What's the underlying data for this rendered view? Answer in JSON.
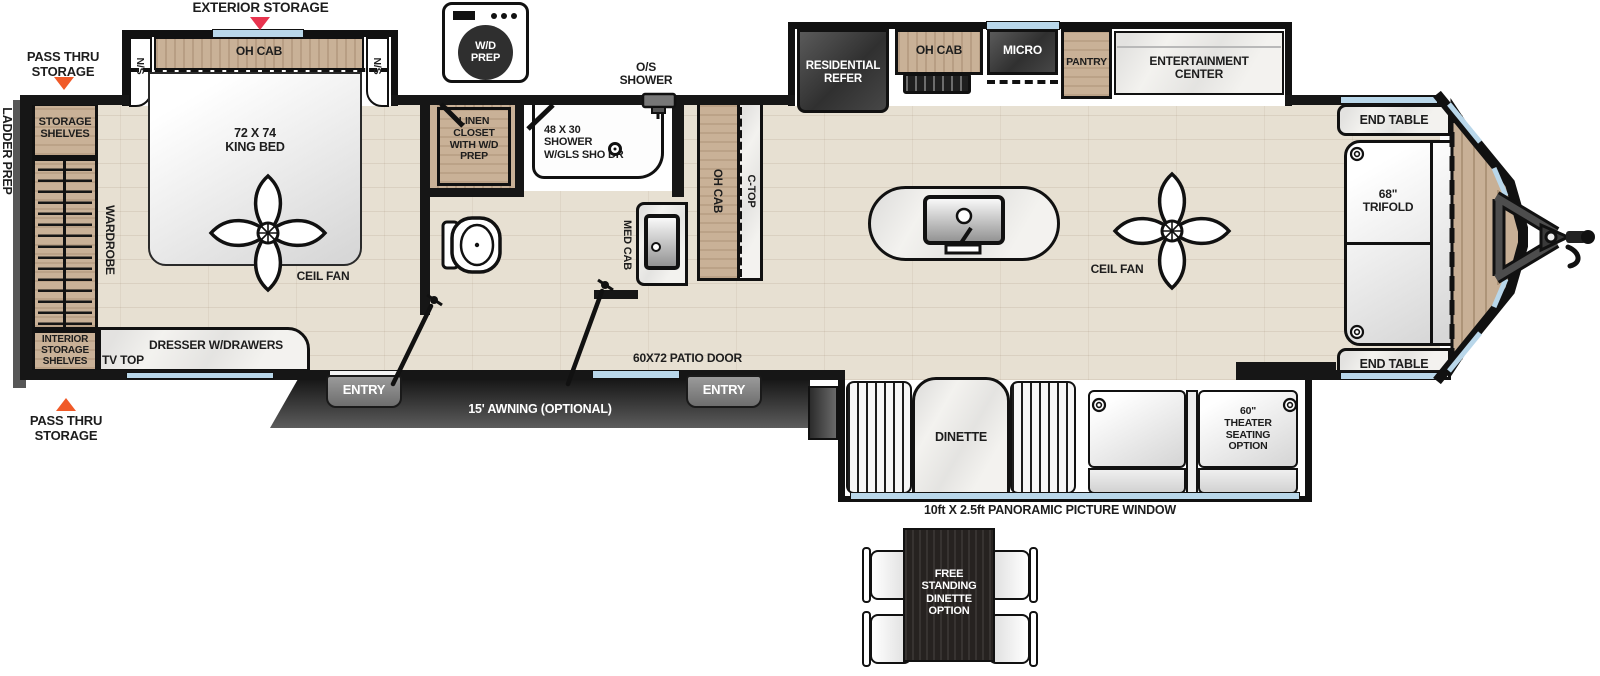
{
  "title": "Travel trailer floorplan",
  "labels": {
    "exterior_storage": "EXTERIOR STORAGE",
    "pass_thru_top": "PASS THRU\nSTORAGE",
    "pass_thru_bottom": "PASS THRU\nSTORAGE",
    "ladder_prep": "LADDER PREP",
    "storage_shelves": "STORAGE\nSHELVES",
    "interior_storage_shelves": "INTERIOR\nSTORAGE\nSHELVES",
    "wardrobe": "WARDROBE",
    "dresser": "DRESSER W/DRAWERS",
    "tv_top": "TV TOP",
    "ns_left": "N/S",
    "ns_right": "N/S",
    "bed_oh_cab": "OH CAB",
    "king_bed": "72 X 74\nKING BED",
    "ceil_fan_bed": "CEIL FAN",
    "wd_prep": "W/D\nPREP",
    "linen_closet": "LINEN\nCLOSET\nWITH W/D\nPREP",
    "os_shower": "O/S\nSHOWER",
    "shower": "48 X 30\nSHOWER\nW/GLS SHO DR",
    "med_cab": "MED CAB",
    "bath_oh_cab": "OH CAB",
    "c_top": "C-TOP",
    "residential_refer": "RESIDENTIAL\nREFER",
    "kitchen_oh_cab": "OH CAB",
    "micro": "MICRO",
    "pantry": "PANTRY",
    "entertainment_center": "ENTERTAINMENT\nCENTER",
    "ceil_fan_living": "CEIL FAN",
    "end_table_top": "END TABLE",
    "end_table_bottom": "END TABLE",
    "trifold": "68\"\nTRIFOLD",
    "front_oh_cab": "OH CAB",
    "dinette": "DINETTE",
    "theater_seating": "60\"\nTHEATER\nSEATING\nOPTION",
    "picture_window": "10ft X 2.5ft PANORAMIC PICTURE WINDOW",
    "entry_left": "ENTRY",
    "entry_right": "ENTRY",
    "awning": "15' AWNING (OPTIONAL)",
    "patio_door": "60X72 PATIO DOOR",
    "free_standing_dinette": "FREE\nSTANDING\nDINETTE\nOPTION"
  },
  "colors": {
    "wall": "#161616",
    "wood_cabinet": "#c9b197",
    "floor": "#e7e0d2",
    "window_blue": "#b9d7ea",
    "marble": "#f3f2ef",
    "appliance_dark": "#3c3c3c",
    "arrow_red": "#e8344f",
    "arrow_orange": "#f05a28",
    "awning_dark": "#2a2a2a"
  }
}
